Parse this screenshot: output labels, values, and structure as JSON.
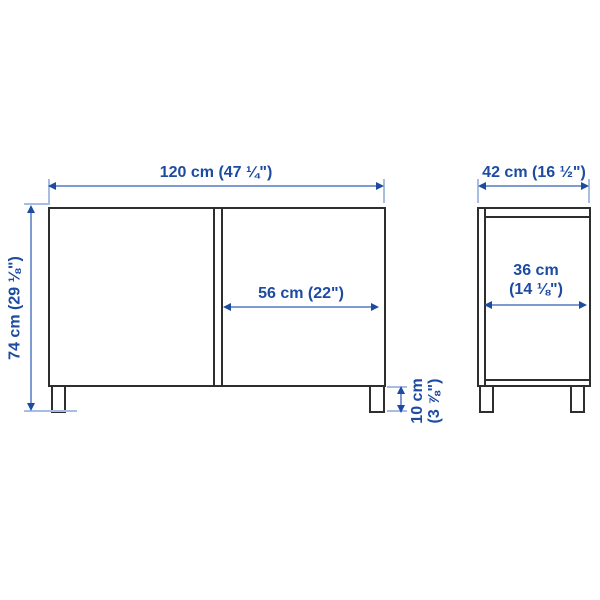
{
  "diagram": {
    "kind": "furniture dimension drawing",
    "front_view": {
      "width_label": "120 cm (47 ¼\")",
      "height_label": "74 cm (29 ⅛\")",
      "door_width_label": "56 cm (22\")",
      "leg_height_label_line1": "10 cm",
      "leg_height_label_line2": "(3 ⅞\")"
    },
    "side_view": {
      "depth_label": "42 cm (16 ½\")",
      "inner_depth_label_line1": "36 cm",
      "inner_depth_label_line2": "(14 ⅛\")"
    }
  },
  "colors": {
    "dimension_text": "#1c4ba1",
    "dimension_line": "#7d9ad1",
    "extension_line": "#a9bce2",
    "outline": "#2e2e2e",
    "background": "#ffffff"
  }
}
